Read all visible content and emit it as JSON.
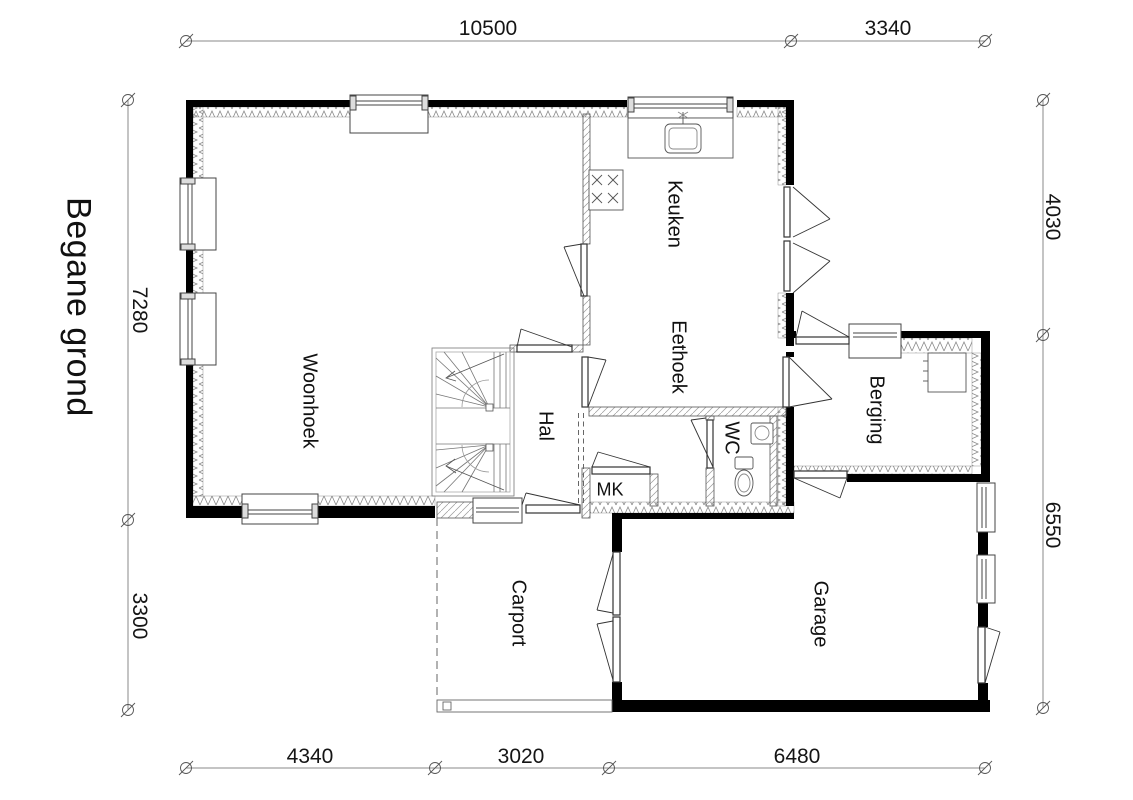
{
  "title": "Begane grond",
  "rooms": [
    {
      "id": "woonhoek",
      "label": "Woonhoek"
    },
    {
      "id": "keuken",
      "label": "Keuken"
    },
    {
      "id": "eethoek",
      "label": "Eethoek"
    },
    {
      "id": "hal",
      "label": "Hal"
    },
    {
      "id": "wc",
      "label": "WC"
    },
    {
      "id": "mk",
      "label": "MK"
    },
    {
      "id": "berging",
      "label": "Berging"
    },
    {
      "id": "carport",
      "label": "Carport"
    },
    {
      "id": "garage",
      "label": "Garage"
    }
  ],
  "dimensions": {
    "top": [
      "10500",
      "3340"
    ],
    "bottom": [
      "4340",
      "3020",
      "6480"
    ],
    "left": [
      "7280",
      "3300"
    ],
    "right": [
      "4030",
      "6550"
    ]
  },
  "colors": {
    "wall": "#000000",
    "hatch": "#8a8a8a",
    "thin_line": "#555555",
    "dim_line": "#888888",
    "background": "#ffffff"
  }
}
